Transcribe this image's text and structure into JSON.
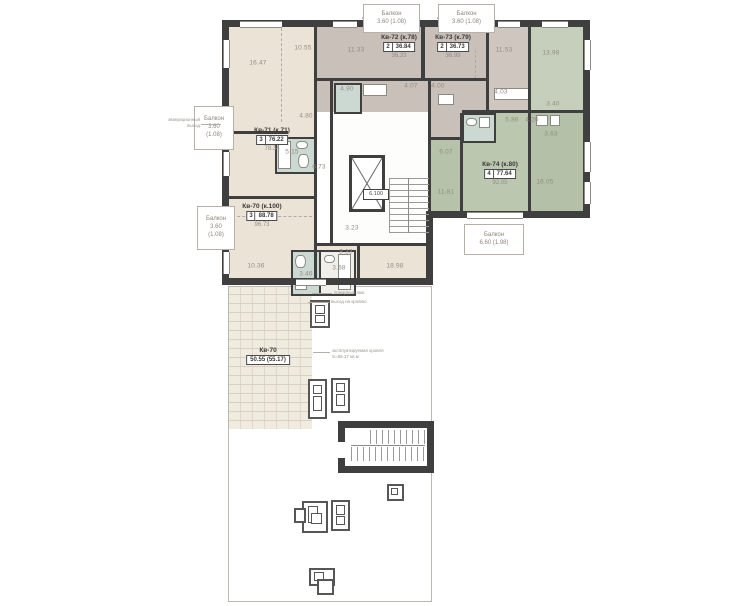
{
  "apartments": [
    {
      "name": "Кв-70 (к.100)",
      "rooms": "3",
      "area": "88.78",
      "total": "96.73"
    },
    {
      "name": "Кв-71 (к.71)",
      "rooms": "3",
      "area": "76.22",
      "total": "78.34"
    },
    {
      "name": "Кв-72 (к.78)",
      "rooms": "2",
      "area": "36.84",
      "total": "36.33"
    },
    {
      "name": "Кв-73 (к.79)",
      "rooms": "2",
      "area": "36.73",
      "total": "36.99"
    },
    {
      "name": "Кв-74 (к.80)",
      "rooms": "4",
      "area": "77.64",
      "total": "92.05"
    }
  ],
  "terrace_label": {
    "name": "Кв-70",
    "area": "50.55 (55.17)"
  },
  "balconies": {
    "top1": {
      "line1": "Балкон",
      "line2": "3.60 (1.08)"
    },
    "top2": {
      "line1": "Балкон",
      "line2": "3.60 (1.08)"
    },
    "left1": {
      "line1": "Балкон",
      "line2": "3.60",
      "line3": "(1.08)"
    },
    "left2": {
      "line1": "Балкон",
      "line2": "3.60",
      "line3": "(1.08)"
    },
    "right1": {
      "line1": "Балкон",
      "line2": "6.60 (1.98)"
    }
  },
  "areas": [
    "16.47",
    "10.55",
    "11.33",
    "11.53",
    "13.98",
    "5.15",
    "4.80",
    "6.73",
    "4.90",
    "4.07",
    "4.00",
    "4.03",
    "3.40",
    "5.86",
    "4.20",
    "3.63",
    "6.07",
    "11.81",
    "16.05",
    "10.36",
    "3.46",
    "3.68",
    "8.33",
    "18.98",
    "3.84",
    "3.23"
  ],
  "core_label": "6.100",
  "annotations": {
    "exit_note_1": "эвакуационный",
    "exit_note_2": "выход",
    "terrace_note_1": "эксплуатируемая кровля",
    "terrace_note_2": "S=55.17 кв.м",
    "hatch_note_1": "пожарный люк",
    "hatch_note_2": "выход на кровлю"
  }
}
